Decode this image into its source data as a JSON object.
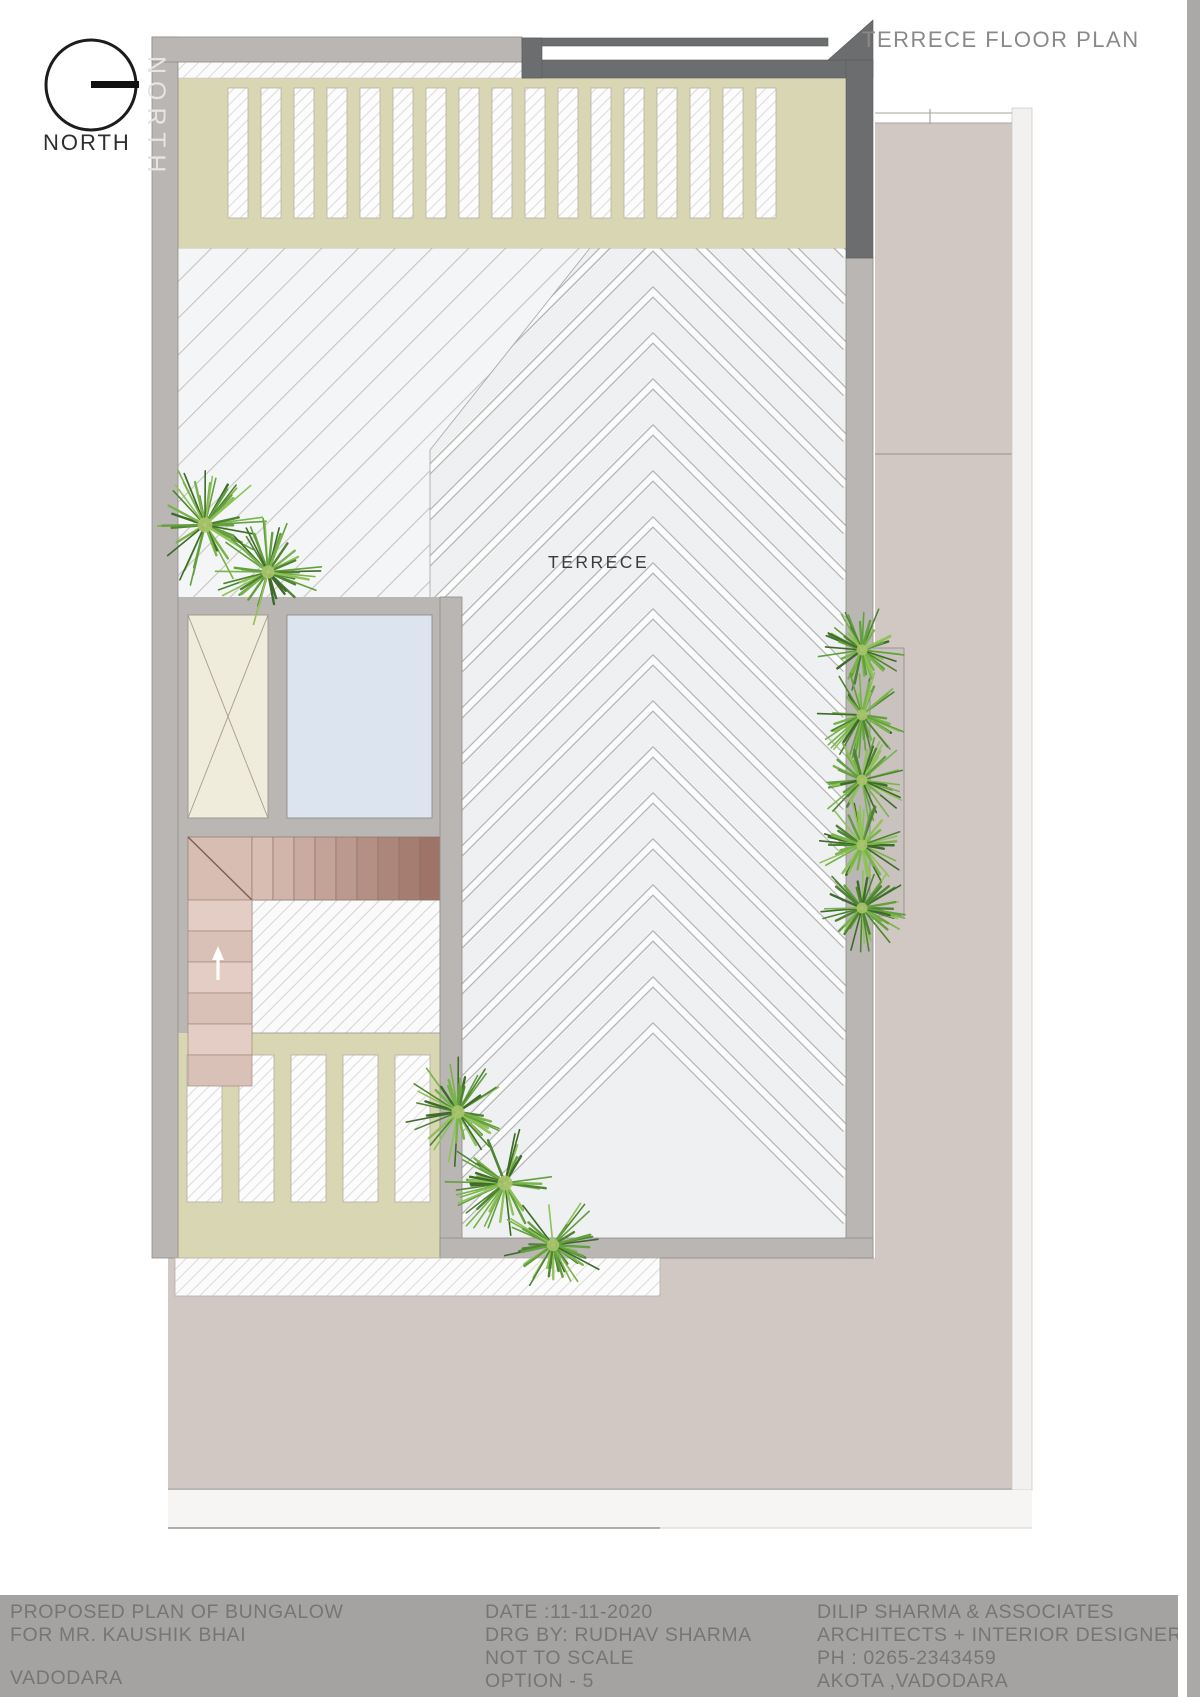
{
  "header": {
    "title": "TERRECE FLOOR PLAN"
  },
  "north": {
    "label": "NORTH",
    "watermark": "NORTH"
  },
  "plan": {
    "room_label": "TERRECE"
  },
  "title_block": {
    "project": {
      "line1": "PROPOSED PLAN OF BUNGALOW",
      "line2": "FOR MR. KAUSHIK BHAI",
      "city": "VADODARA"
    },
    "drawing": {
      "date": "DATE :11-11-2020",
      "drg_by": "DRG BY: RUDHAV SHARMA",
      "scale": "NOT TO SCALE",
      "option": "OPTION - 5"
    },
    "firm": {
      "name": "DILIP SHARMA & ASSOCIATES",
      "tagline": "ARCHITECTS + INTERIOR DESIGNERS",
      "phone": "PH : 0265-2343459",
      "address": "AKOTA ,VADODARA"
    }
  },
  "palette": {
    "page": "#ffffff",
    "titlebar_bg": "#a5a3a1",
    "titlebar_text": "#787674",
    "wall_gray": "#b9b6b3",
    "canopy_dark": "#6b6d6f",
    "pergola_beige": "#d9d6b3",
    "terrace_band": "#eef0f2",
    "tank_cream": "#efecdb",
    "tank_blue": "#dce4ef",
    "stair_pink_light": "#e3cdc4",
    "stair_pink_dark": "#9f7468",
    "roof_pink": "#d1c7c3",
    "plant_green": "#63a03e"
  }
}
